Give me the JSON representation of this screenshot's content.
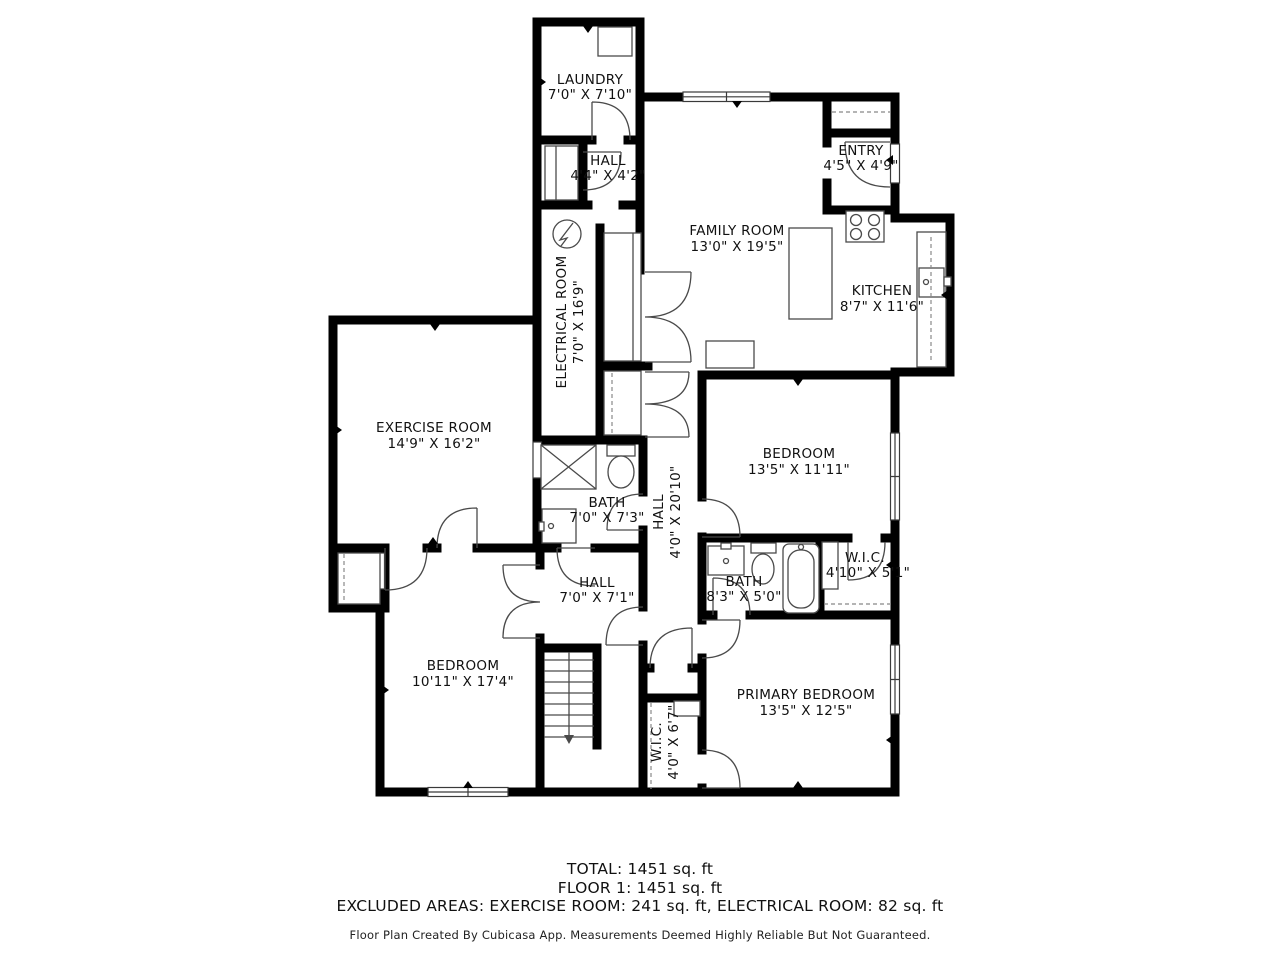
{
  "rooms": {
    "laundry": {
      "name": "LAUNDRY",
      "dims": "7'0\" X 7'10\""
    },
    "hall_top": {
      "name": "HALL",
      "dims": "4'4\" X 4'2\""
    },
    "entry": {
      "name": "ENTRY",
      "dims": "4'5\" X 4'9\""
    },
    "family_room": {
      "name": "FAMILY ROOM",
      "dims": "13'0\" X 19'5\""
    },
    "kitchen": {
      "name": "KITCHEN",
      "dims": "8'7\" X 11'6\""
    },
    "electrical_room": {
      "name": "ELECTRICAL ROOM",
      "dims": "7'0\" X 16'9\""
    },
    "exercise_room": {
      "name": "EXERCISE ROOM",
      "dims": "14'9\" X 16'2\""
    },
    "bath_middle": {
      "name": "BATH",
      "dims": "7'0\" X 7'3\""
    },
    "hall_main": {
      "name": "HALL",
      "dims": "4'0\" X 20'10\""
    },
    "bedroom_right": {
      "name": "BEDROOM",
      "dims": "13'5\" X 11'11\""
    },
    "bath_primary": {
      "name": "BATH",
      "dims": "8'3\" X 5'0\""
    },
    "wic_right": {
      "name": "W.I.C.",
      "dims": "4'10\" X 5'1\""
    },
    "hall_lower": {
      "name": "HALL",
      "dims": "7'0\" X 7'1\""
    },
    "bedroom_left": {
      "name": "BEDROOM",
      "dims": "10'11\" X 17'4\""
    },
    "primary_bedroom": {
      "name": "PRIMARY BEDROOM",
      "dims": "13'5\" X 12'5\""
    },
    "wic_bottom": {
      "name": "W.I.C.",
      "dims": "4'0\" X 6'7\""
    }
  },
  "summary": {
    "total": "TOTAL: 1451 sq. ft",
    "floor": "FLOOR 1: 1451 sq. ft",
    "excluded": "EXCLUDED AREAS: EXERCISE ROOM: 241 sq. ft, ELECTRICAL ROOM: 82 sq. ft",
    "disclaimer": "Floor Plan Created By Cubicasa App. Measurements Deemed Highly Reliable But Not Guaranteed."
  },
  "fixtures": [
    "washing-machine",
    "electrical-panel",
    "shower",
    "toilet",
    "sink",
    "bathtub",
    "stove",
    "kitchen-sink",
    "kitchen-counter",
    "stairs",
    "closet-shelf",
    "front-door"
  ],
  "colors": {
    "wall": "#000000",
    "fixture_line": "#4a4a4a",
    "dashed_line": "#888888",
    "text": "#111111",
    "background": "#ffffff"
  }
}
